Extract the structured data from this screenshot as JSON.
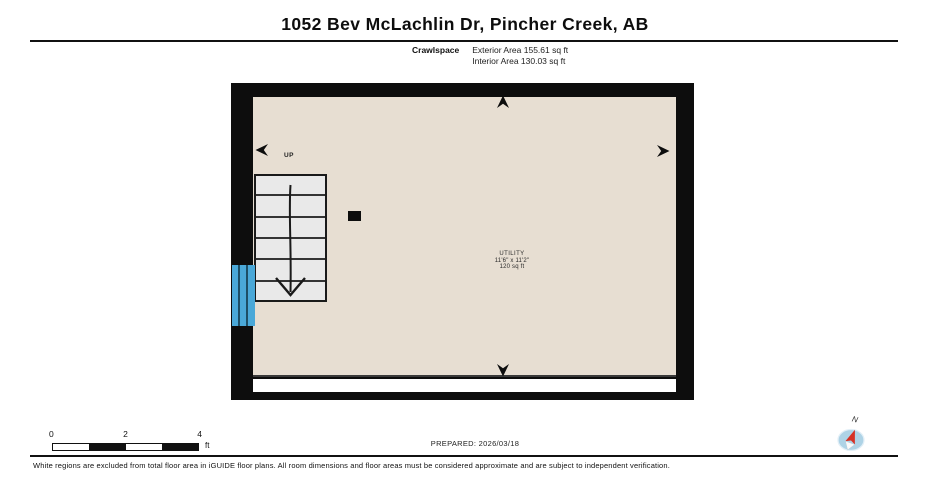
{
  "header": {
    "title": "1052 Bev McLachlin Dr, Pincher Creek, AB",
    "floor_label": "Crawlspace",
    "exterior_area": "Exterior Area 155.61 sq ft",
    "interior_area": "Interior Area 130.03 sq ft"
  },
  "plan": {
    "stairs_label": "UP",
    "room": {
      "name": "UTILITY",
      "dimensions": "11'6\" x 11'2\"",
      "area": "120 sq ft"
    }
  },
  "footer": {
    "scale_ticks": [
      "0",
      "2",
      "4"
    ],
    "scale_unit": "ft",
    "prepared": "PREPARED: 2026/03/18",
    "compass_label": "N",
    "disclaimer": "White regions are excluded from total floor area in iGUIDE floor plans. All room dimensions and floor areas must be considered approximate and are subject to independent verification."
  },
  "colors": {
    "wall": "#0d0d0d",
    "floor": "#e7ded2",
    "excluded_region": "#ffffff",
    "stairs_fill": "#e9e9e9",
    "window_blue": "#4aa8d8",
    "compass_fill": "#aed3e6",
    "compass_needle": "#d63226"
  }
}
